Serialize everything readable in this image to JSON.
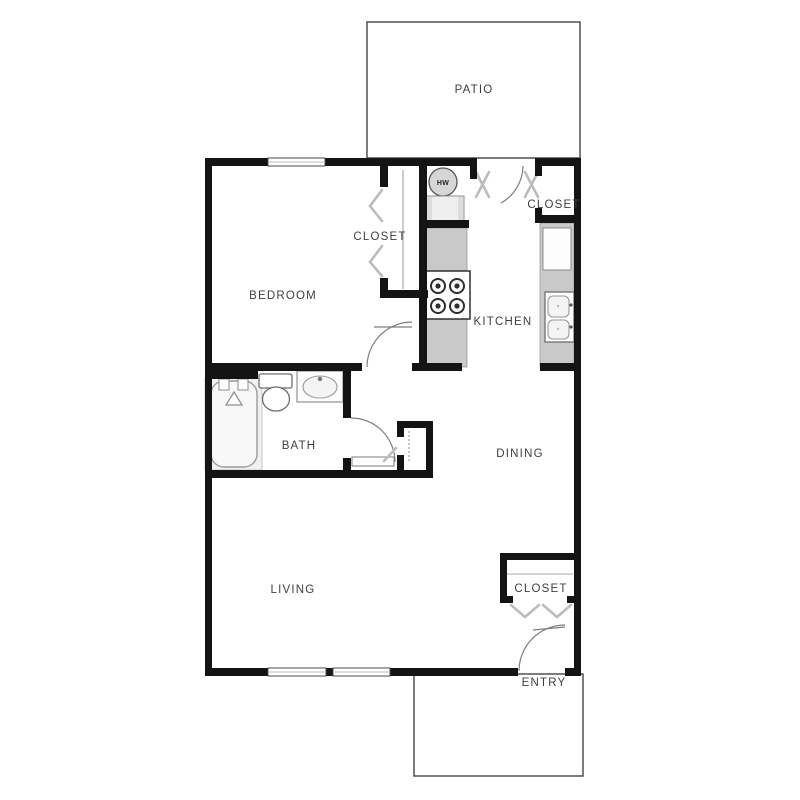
{
  "floorplan": {
    "rooms": {
      "patio": "PATIO",
      "bedroom": "BEDROOM",
      "bedroom_closet": "CLOSET",
      "kitchen_closet": "CLOSET",
      "kitchen": "KITCHEN",
      "bath": "BATH",
      "dining": "DINING",
      "living": "LIVING",
      "entry_closet": "CLOSET",
      "entry": "ENTRY"
    },
    "appliances": {
      "water_heater": "HW"
    },
    "fixtures": [
      "bathtub-icon",
      "shower-head-icon",
      "toilet-icon",
      "vanity-sink-icon",
      "range-stove-icon",
      "refrigerator-icon",
      "kitchen-sink-icon",
      "washer-icon",
      "water-heater-icon"
    ],
    "colors": {
      "wall": "#141414",
      "counter": "#c9c9c9",
      "label_text": "#3f3f3f",
      "swing_marker": "#bcbcbc",
      "fixture_outline": "#6e6e6e",
      "background": "#ffffff"
    }
  }
}
